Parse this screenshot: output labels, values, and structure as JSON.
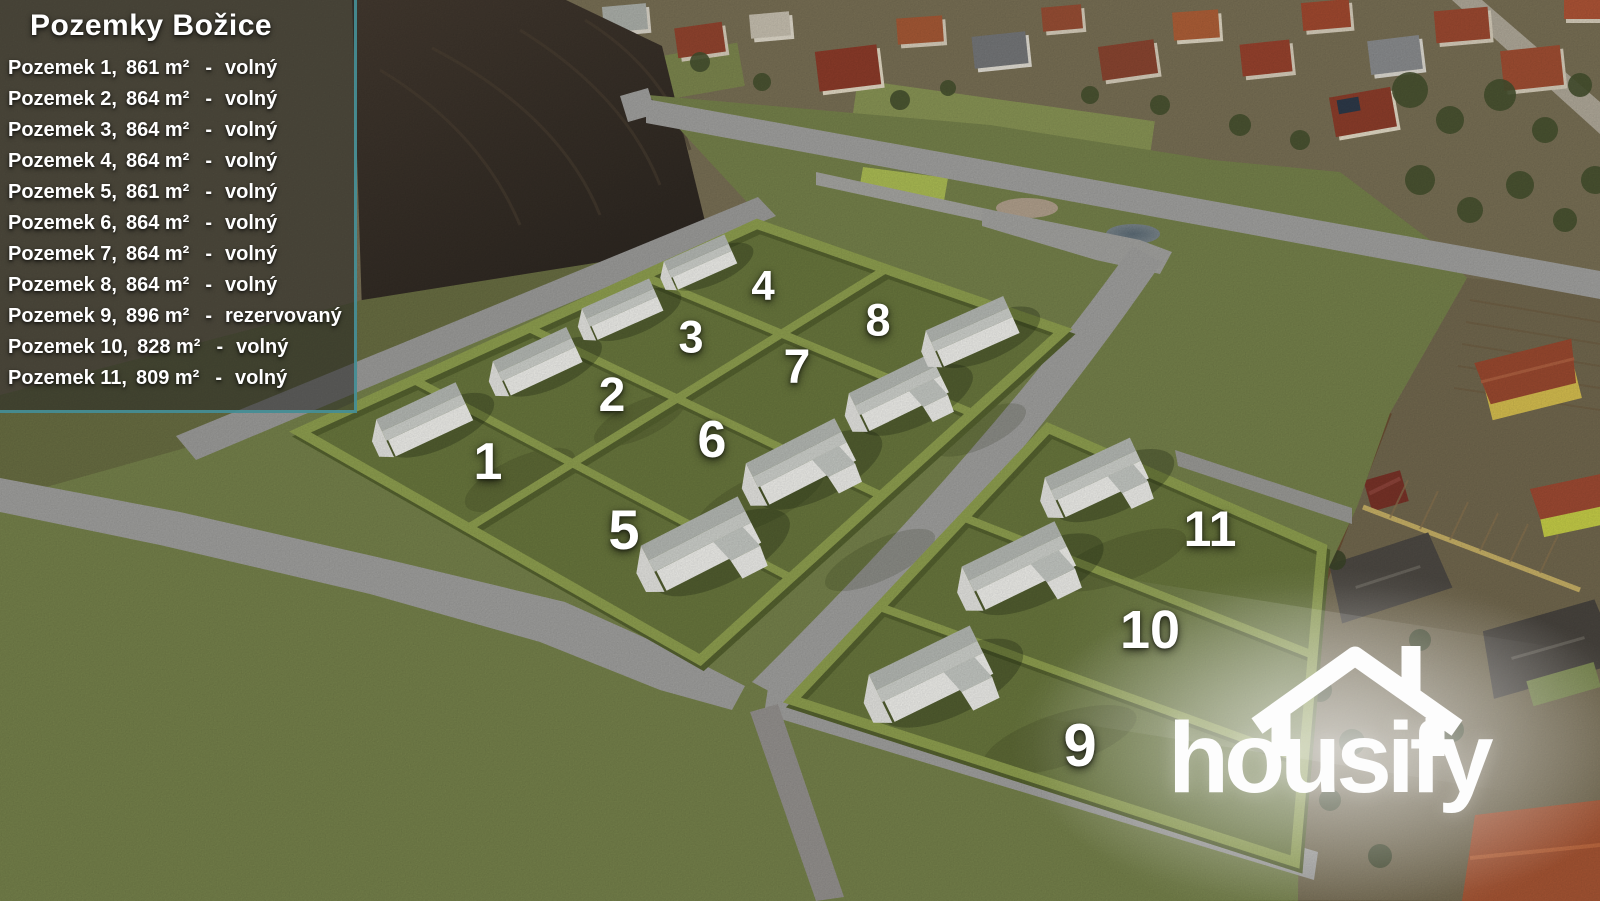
{
  "legend": {
    "title": "Pozemky Božice",
    "separator": "-",
    "items": [
      {
        "label": "Pozemek 1,",
        "area": "861 m²",
        "status": "volný"
      },
      {
        "label": "Pozemek 2,",
        "area": "864 m²",
        "status": "volný"
      },
      {
        "label": "Pozemek 3,",
        "area": "864 m²",
        "status": "volný"
      },
      {
        "label": "Pozemek 4,",
        "area": "864 m²",
        "status": "volný"
      },
      {
        "label": "Pozemek 5,",
        "area": "861 m²",
        "status": "volný"
      },
      {
        "label": "Pozemek 6,",
        "area": "864 m²",
        "status": "volný"
      },
      {
        "label": "Pozemek 7,",
        "area": "864 m²",
        "status": "volný"
      },
      {
        "label": "Pozemek 8,",
        "area": "864 m²",
        "status": "volný"
      },
      {
        "label": "Pozemek 9,",
        "area": "896 m²",
        "status": "rezervovaný"
      },
      {
        "label": "Pozemek 10,",
        "area": "828 m²",
        "status": "volný"
      },
      {
        "label": "Pozemek 11,",
        "area": "809 m²",
        "status": "volný"
      }
    ]
  },
  "plots": [
    {
      "number": "1"
    },
    {
      "number": "2"
    },
    {
      "number": "3"
    },
    {
      "number": "4"
    },
    {
      "number": "5"
    },
    {
      "number": "6"
    },
    {
      "number": "7"
    },
    {
      "number": "8"
    },
    {
      "number": "9"
    },
    {
      "number": "10"
    },
    {
      "number": "11"
    }
  ],
  "logo": {
    "text": "housify"
  },
  "colors": {
    "accent_teal": "#4898a0",
    "render_grass": "#77834c",
    "plot_grass": "#6a783e",
    "hedge": "#90a150",
    "road": "#a2a2a0",
    "field": "#38302a",
    "house_wall": "#f2f2ee",
    "house_roof": "#b7bbb6",
    "text": "#ffffff"
  }
}
